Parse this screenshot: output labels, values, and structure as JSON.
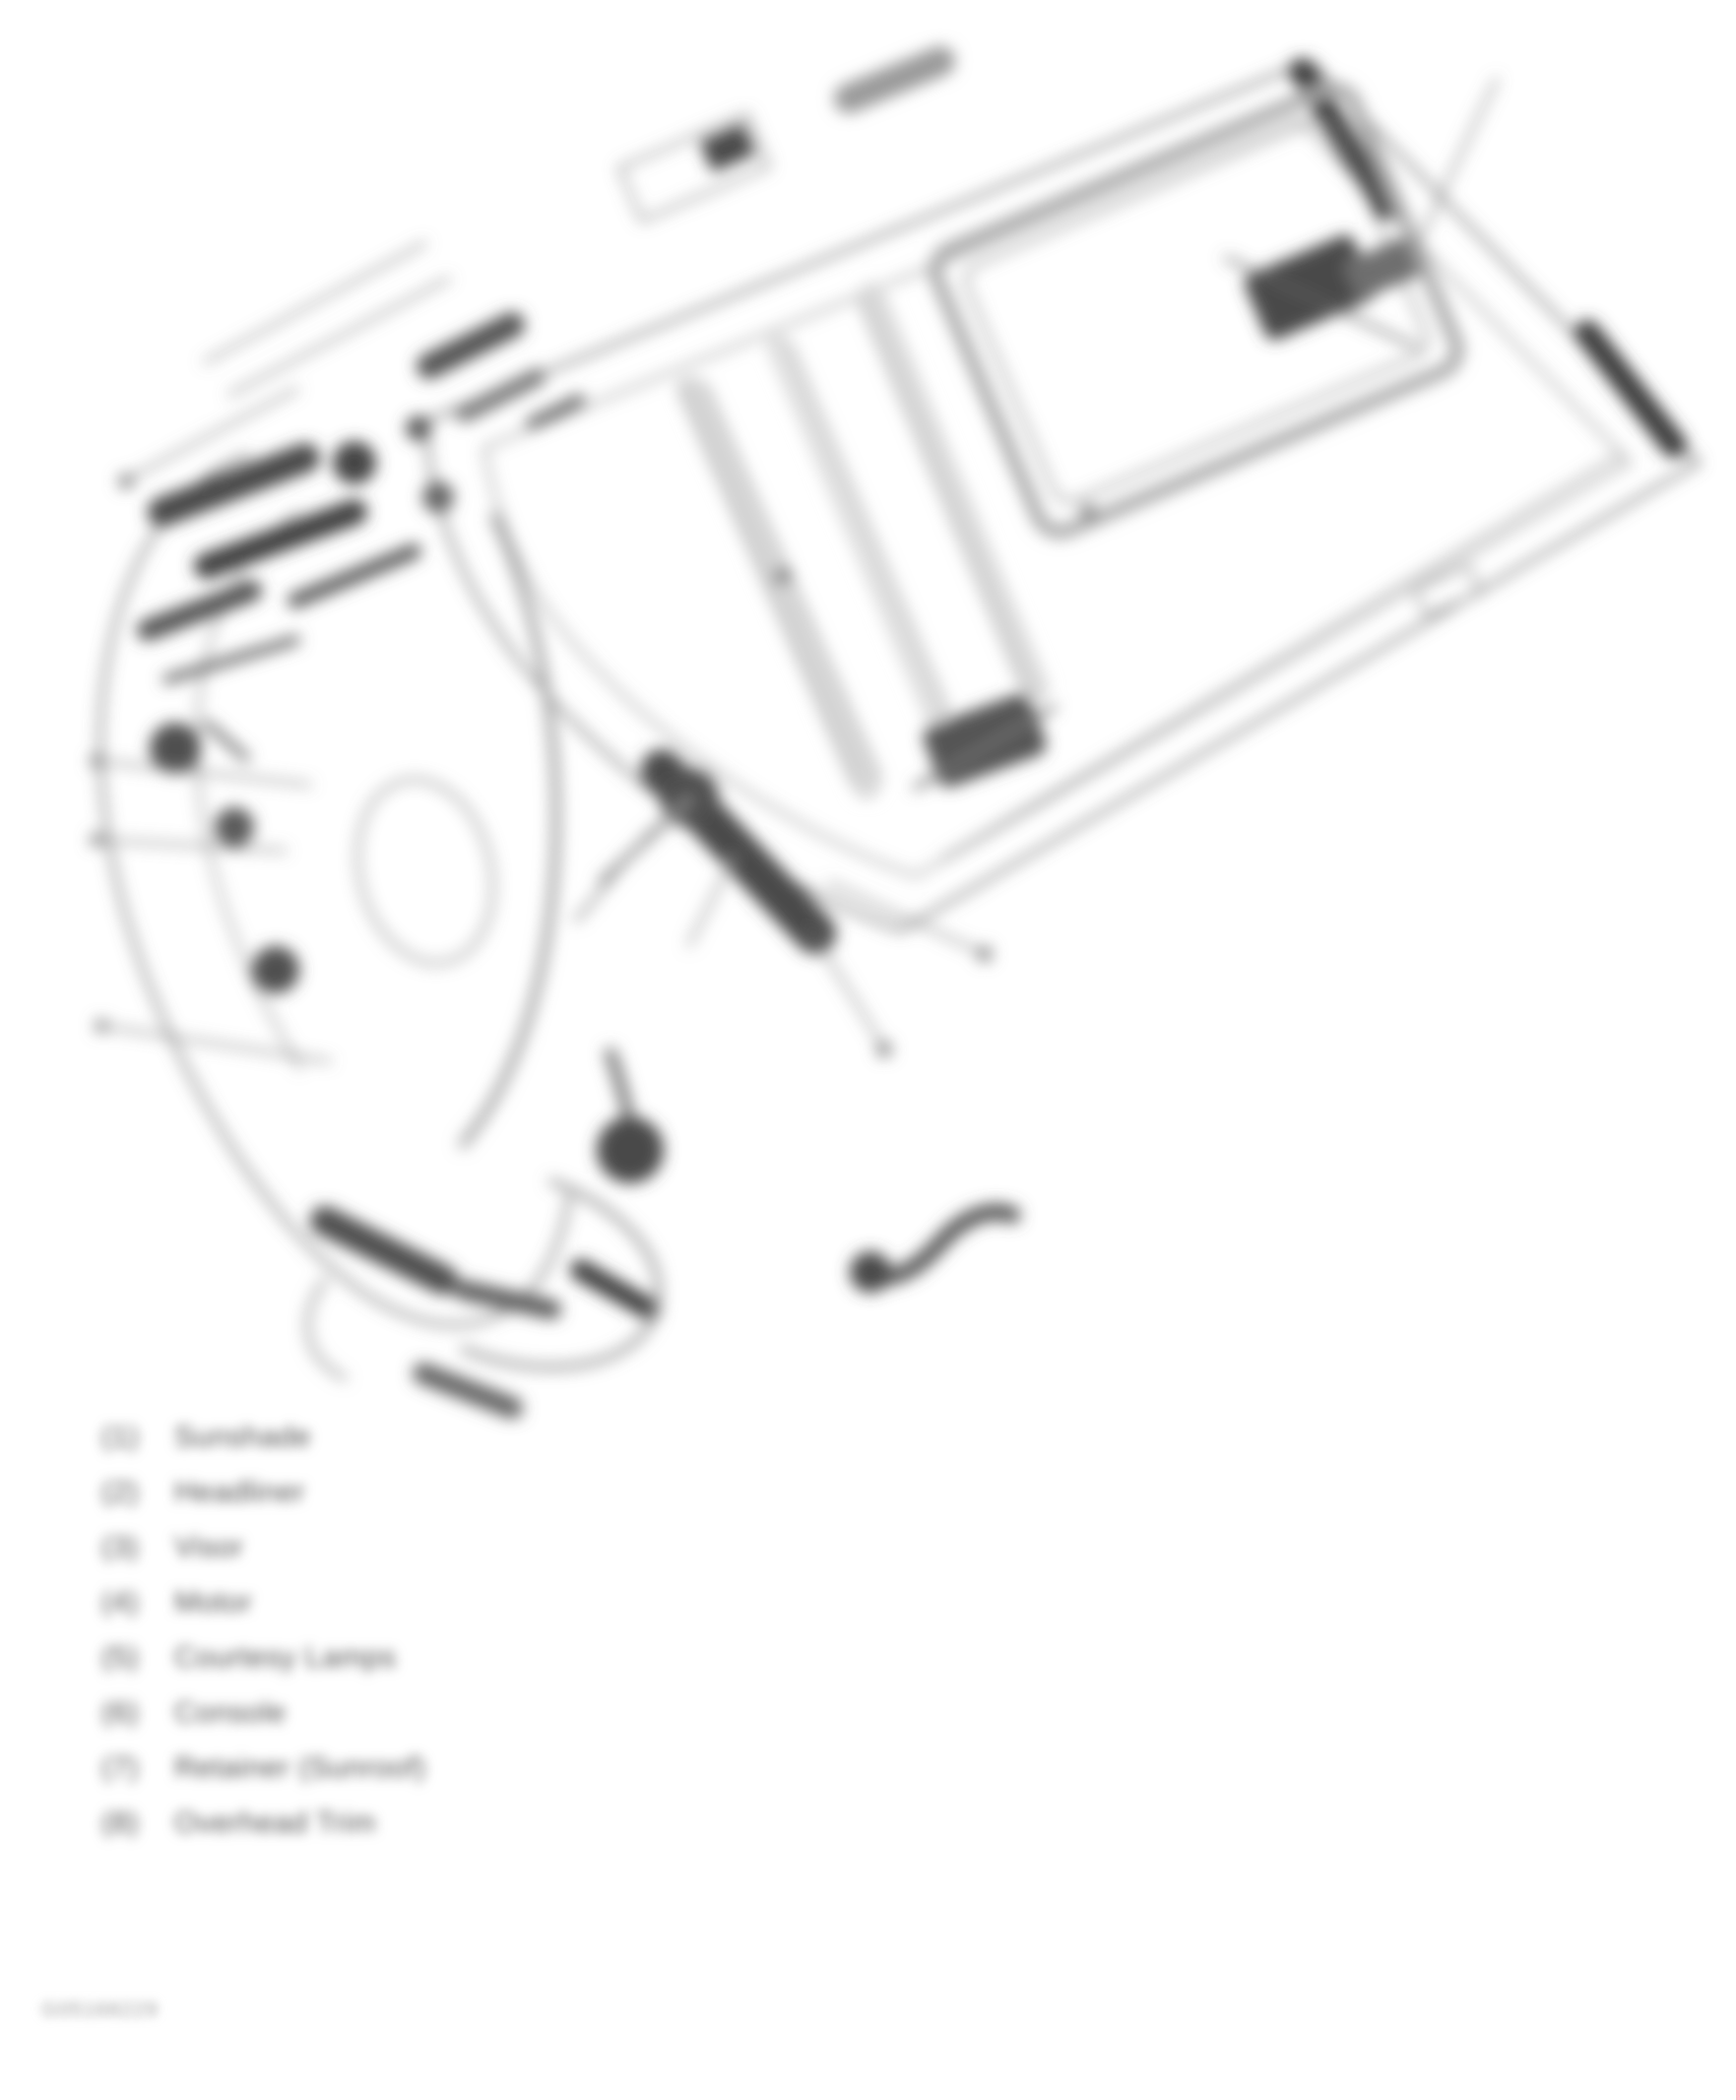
{
  "figure": {
    "kind": "blurred technical line-art illustration",
    "subject": "vehicle roof headliner assembly with numbered callout lines",
    "legibility": "heavily blurred scan; all text is an approximation of smudged glyphs",
    "colors": {
      "background": "#ffffff",
      "ink_dark": "#3c3c3c",
      "ink_mid": "#6f6f6f",
      "ink_light": "#c9c9c9",
      "text": "#4b4b4b",
      "code": "#9a9a9a"
    }
  },
  "legend": {
    "items": [
      {
        "number": "(1)",
        "label": "Sunshade"
      },
      {
        "number": "(2)",
        "label": "Headliner"
      },
      {
        "number": "(3)",
        "label": "Visor"
      },
      {
        "number": "(4)",
        "label": "Motor"
      },
      {
        "number": "(5)",
        "label": "Courtesy Lamps"
      },
      {
        "number": "(6)",
        "label": "Console"
      },
      {
        "number": "(7)",
        "label": "Retainer (Sunroof)"
      },
      {
        "number": "(8)",
        "label": "Overhead Trim"
      }
    ]
  },
  "footer": {
    "figure_code": "G05168229"
  }
}
